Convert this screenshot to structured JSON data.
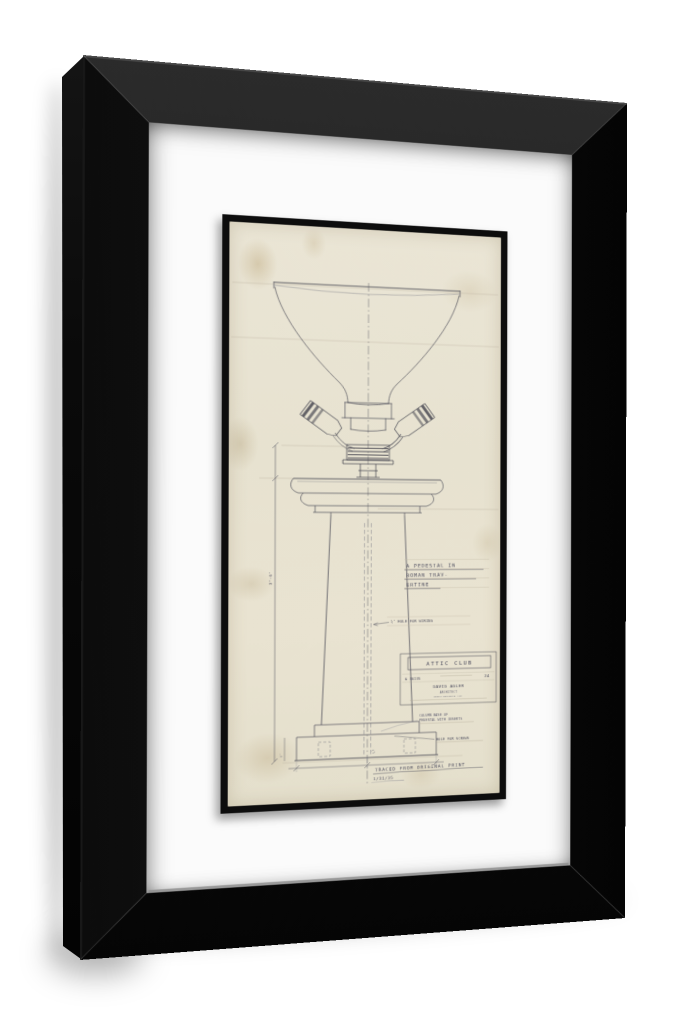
{
  "drawing": {
    "annotation_title": {
      "line1": "A PEDESTAL IN",
      "line2": "ROMAN TRAV-",
      "line3": "ERTINE"
    },
    "notes": {
      "wiring": "½″ HOLE FOR WIRING",
      "base_line1": "COLUMN BASE OF",
      "base_line2": "PEDESTAL WITH INSERTS",
      "screws": "HOLE FOR SCREWS",
      "traced": "TRACED FROM ORIGINAL PRINT",
      "traced_date": "1/31/35"
    },
    "dimensions": {
      "height": "3'-6″",
      "base": "6″"
    },
    "title_block": {
      "client": "ATTIC CLUB",
      "number": "№ 36135",
      "sheet": "24",
      "architect": "DAVID ADLER",
      "architect_title": "ARCHITECT",
      "address": "NORTH MICHIGAN AVE."
    },
    "colors": {
      "frame": "#101010",
      "mat": "#fbfbfb",
      "paper": "#e8e3d1",
      "pencil": "#52525c"
    }
  }
}
